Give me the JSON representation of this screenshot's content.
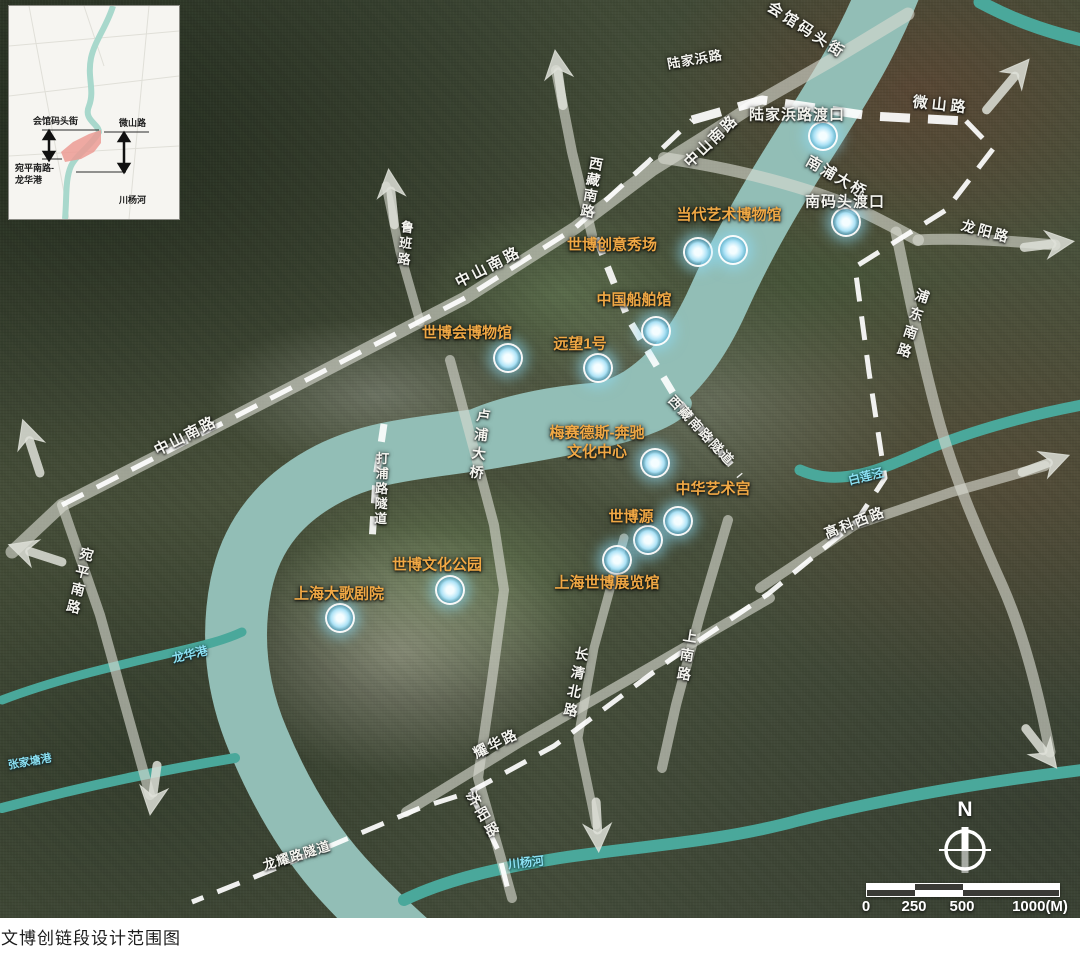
{
  "caption": "文博创链段设计范围图",
  "compass": {
    "north_label": "N"
  },
  "scalebar": {
    "unit_note": "1000(M)",
    "ticks": [
      {
        "label": "0",
        "pos": 4
      },
      {
        "label": "250",
        "pos": 52
      },
      {
        "label": "500",
        "pos": 100
      },
      {
        "label": "1000(M)",
        "pos": 178
      }
    ]
  },
  "inset": {
    "top_left": "会馆码头街",
    "top_right": "微山路",
    "bottom_left": "宛平南路-\n龙华港",
    "bottom_right": "川杨河",
    "highlight_color": "#ec9b94"
  },
  "colors": {
    "venue_label": "#f0a845",
    "road_label": "#f4f4ef",
    "river_label": "#8be0f2",
    "marker_glow": "#9fdcf2",
    "boundary_dash": "#ffffff",
    "water": "#92beb6"
  },
  "map": {
    "labels": [
      {
        "t": "会馆码头街",
        "c": "road",
        "x": 806,
        "y": 31,
        "r": 33,
        "s": 15,
        "ls": 3
      },
      {
        "t": "陆家浜路",
        "c": "road",
        "x": 695,
        "y": 60,
        "r": -10,
        "s": 13,
        "ls": 1
      },
      {
        "t": "微山路",
        "c": "road",
        "x": 941,
        "y": 106,
        "r": 6,
        "s": 15,
        "ls": 4
      },
      {
        "t": "中山南路",
        "c": "road",
        "x": 712,
        "y": 142,
        "r": -44,
        "s": 15,
        "ls": 2
      },
      {
        "t": "南浦大桥",
        "c": "road",
        "x": 836,
        "y": 178,
        "r": 30,
        "s": 15,
        "ls": 2
      },
      {
        "t": "西藏南路",
        "c": "road",
        "x": 591,
        "y": 188,
        "r": 10,
        "s": 14,
        "ls": 2,
        "v": 1
      },
      {
        "t": "鲁班路",
        "c": "road",
        "x": 404,
        "y": 244,
        "r": 6,
        "s": 13,
        "ls": 3,
        "v": 1
      },
      {
        "t": "中山南路",
        "c": "road",
        "x": 489,
        "y": 268,
        "r": -27,
        "s": 15,
        "ls": 3
      },
      {
        "t": "龙阳路",
        "c": "road",
        "x": 986,
        "y": 232,
        "r": 15,
        "s": 14,
        "ls": 3
      },
      {
        "t": "浦东南路",
        "c": "road",
        "x": 912,
        "y": 325,
        "r": 18,
        "s": 14,
        "ls": 5,
        "v": 1
      },
      {
        "t": "打浦路隧道",
        "c": "road",
        "x": 380,
        "y": 489,
        "r": 2,
        "s": 13,
        "ls": 2,
        "v": 1
      },
      {
        "t": "卢浦大桥",
        "c": "road",
        "x": 479,
        "y": 446,
        "r": 7,
        "s": 14,
        "ls": 5,
        "v": 1
      },
      {
        "t": "西藏南路隧道",
        "c": "road",
        "x": 701,
        "y": 431,
        "r": 47,
        "s": 13,
        "ls": 2
      },
      {
        "t": "中山南路",
        "c": "road",
        "x": 186,
        "y": 437,
        "r": -27,
        "s": 15,
        "ls": 2
      },
      {
        "t": "宛平南路",
        "c": "road",
        "x": 79,
        "y": 582,
        "r": 14,
        "s": 14,
        "ls": 4,
        "v": 1
      },
      {
        "t": "上南路",
        "c": "road",
        "x": 686,
        "y": 657,
        "r": 9,
        "s": 14,
        "ls": 5,
        "v": 1
      },
      {
        "t": "长清北路",
        "c": "road",
        "x": 575,
        "y": 684,
        "r": 11,
        "s": 14,
        "ls": 5,
        "v": 1
      },
      {
        "t": "耀华路",
        "c": "road",
        "x": 496,
        "y": 744,
        "r": -26,
        "s": 14,
        "ls": 2
      },
      {
        "t": "高科西路",
        "c": "road",
        "x": 855,
        "y": 523,
        "r": -21,
        "s": 14,
        "ls": 2
      },
      {
        "t": "济阳路",
        "c": "road",
        "x": 483,
        "y": 816,
        "r": 60,
        "s": 14,
        "ls": 4
      },
      {
        "t": "龙耀路隧道",
        "c": "road",
        "x": 297,
        "y": 856,
        "r": -17,
        "s": 13,
        "ls": 1
      },
      {
        "t": "陆家浜路渡口",
        "c": "ferry",
        "x": 797,
        "y": 116,
        "r": 0,
        "s": 15,
        "ls": 1
      },
      {
        "t": "南码头渡口",
        "c": "ferry",
        "x": 845,
        "y": 203,
        "r": 0,
        "s": 15,
        "ls": 1
      },
      {
        "t": "当代艺术博物馆",
        "c": "venue",
        "x": 729,
        "y": 216,
        "r": 0,
        "s": 15
      },
      {
        "t": "世博创意秀场",
        "c": "venue",
        "x": 612,
        "y": 246,
        "r": 0,
        "s": 15
      },
      {
        "t": "中国船舶馆",
        "c": "venue",
        "x": 634,
        "y": 301,
        "r": 0,
        "s": 15
      },
      {
        "t": "世博会博物馆",
        "c": "venue",
        "x": 467,
        "y": 334,
        "r": 0,
        "s": 15
      },
      {
        "t": "远望1号",
        "c": "venue",
        "x": 580,
        "y": 345,
        "r": 0,
        "s": 15
      },
      {
        "t": "梅赛德斯-奔驰\n文化中心",
        "c": "venue",
        "x": 597,
        "y": 443,
        "r": 0,
        "s": 15
      },
      {
        "t": "中华艺术宫",
        "c": "venue",
        "x": 713,
        "y": 490,
        "r": 0,
        "s": 15
      },
      {
        "t": "世博源",
        "c": "venue",
        "x": 631,
        "y": 518,
        "r": 0,
        "s": 15
      },
      {
        "t": "上海世博展览馆",
        "c": "venue",
        "x": 607,
        "y": 584,
        "r": 0,
        "s": 15
      },
      {
        "t": "世博文化公园",
        "c": "venue",
        "x": 437,
        "y": 566,
        "r": 0,
        "s": 15
      },
      {
        "t": "上海大歌剧院",
        "c": "venue",
        "x": 339,
        "y": 595,
        "r": 0,
        "s": 15
      },
      {
        "t": "白莲泾",
        "c": "river",
        "x": 866,
        "y": 477,
        "r": -14,
        "s": 12
      },
      {
        "t": "川杨河",
        "c": "river",
        "x": 526,
        "y": 863,
        "r": -6,
        "s": 12
      },
      {
        "t": "龙华港",
        "c": "river",
        "x": 190,
        "y": 655,
        "r": -14,
        "s": 12
      },
      {
        "t": "张家塘港",
        "c": "river",
        "x": 30,
        "y": 763,
        "r": -10,
        "s": 11
      }
    ],
    "markers": [
      {
        "name": "陆家浜路渡口",
        "x": 823,
        "y": 136
      },
      {
        "name": "南码头渡口",
        "x": 846,
        "y": 222
      },
      {
        "name": "世博创意秀场",
        "x": 698,
        "y": 252
      },
      {
        "name": "当代艺术博物馆",
        "x": 733,
        "y": 250
      },
      {
        "name": "中国船舶馆",
        "x": 656,
        "y": 331
      },
      {
        "name": "世博会博物馆",
        "x": 508,
        "y": 358
      },
      {
        "name": "远望1号",
        "x": 598,
        "y": 368
      },
      {
        "name": "梅赛德斯-奔驰文化中心",
        "x": 655,
        "y": 463
      },
      {
        "name": "中华艺术宫",
        "x": 678,
        "y": 521
      },
      {
        "name": "世博源",
        "x": 648,
        "y": 540
      },
      {
        "name": "上海世博展览馆",
        "x": 617,
        "y": 560
      },
      {
        "name": "世博文化公园",
        "x": 450,
        "y": 590
      },
      {
        "name": "上海大歌剧院",
        "x": 340,
        "y": 618
      }
    ]
  }
}
